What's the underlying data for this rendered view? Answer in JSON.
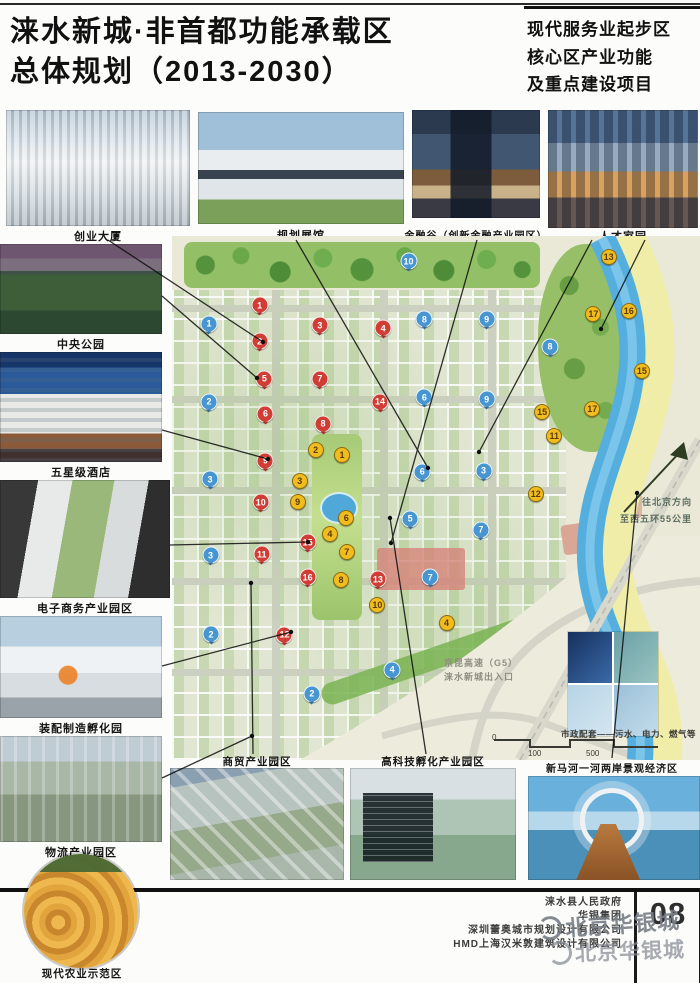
{
  "header": {
    "title_line1": "涞水新城·非首都功能承载区",
    "title_line2": "总体规划（2013-2030）",
    "subtitle_line1": "现代服务业起步区",
    "subtitle_line2": "核心区产业功能",
    "subtitle_line3": "及重点建设项目"
  },
  "top_photos": [
    "创业大厦",
    "规划展馆",
    "金融谷（创新金融产业园区）",
    "人才家园"
  ],
  "left_photos": [
    "中央公园",
    "五星级酒店",
    "电子商务产业园区",
    "装配制造孵化园",
    "物流产业园区",
    "现代农业示范区"
  ],
  "bottom_photos": [
    "商贸产业园区",
    "高科技孵化产业园区",
    "新马河一河两岸景观经济区"
  ],
  "map": {
    "annotations": {
      "direction": "往北京方向",
      "distance": "至西五环55公里",
      "expressway": "京昆高速（G5）",
      "exit": "涞水新城出入口",
      "municipal": "市政配套——污水、电力、燃气等"
    },
    "scale": [
      "0",
      "100",
      "500"
    ],
    "markers": {
      "red": [
        [
          "1",
          16.6,
          13.2
        ],
        [
          "2",
          16.6,
          20.1
        ],
        [
          "3",
          28,
          17
        ],
        [
          "4",
          40,
          17.6
        ],
        [
          "5",
          17.5,
          27.2
        ],
        [
          "6",
          17.7,
          33.9
        ],
        [
          "7",
          28,
          27.2
        ],
        [
          "8",
          28.6,
          35.8
        ],
        [
          "9",
          17.7,
          42.9
        ],
        [
          "10",
          16.8,
          50.8
        ],
        [
          "11",
          17,
          60.7
        ],
        [
          "12",
          21.3,
          76.1
        ],
        [
          "13",
          39,
          65.5
        ],
        [
          "14",
          39.4,
          31.6
        ],
        [
          "15",
          25.7,
          58.4
        ],
        [
          "16",
          25.7,
          65.1
        ]
      ],
      "blue": [
        [
          "1",
          7,
          16.7
        ],
        [
          "2",
          7,
          31.6
        ],
        [
          "3",
          7.2,
          46.4
        ],
        [
          "3",
          7.3,
          60.9
        ],
        [
          "2",
          7.4,
          76
        ],
        [
          "10",
          44.8,
          4.8
        ],
        [
          "8",
          47.8,
          15.9
        ],
        [
          "9",
          59.6,
          15.9
        ],
        [
          "6",
          47.8,
          30.8
        ],
        [
          "9",
          59.6,
          31.2
        ],
        [
          "6",
          47.4,
          45
        ],
        [
          "3",
          59,
          44.8
        ],
        [
          "5",
          45.1,
          54
        ],
        [
          "7",
          58.5,
          56.1
        ],
        [
          "7",
          48.9,
          65.1
        ],
        [
          "8",
          71.6,
          21.1
        ],
        [
          "4",
          41.7,
          82.8
        ],
        [
          "2",
          26.5,
          87.4
        ]
      ],
      "yellow": [
        [
          "2",
          27.2,
          40.8
        ],
        [
          "1",
          32.2,
          41.8
        ],
        [
          "3",
          24.2,
          46.7
        ],
        [
          "9",
          23.8,
          50.8
        ],
        [
          "6",
          33,
          53.8
        ],
        [
          "4",
          29.9,
          56.9
        ],
        [
          "7",
          33.1,
          60.3
        ],
        [
          "8",
          32,
          65.7
        ],
        [
          "10",
          38.9,
          70.5
        ],
        [
          "4",
          52,
          73.8
        ],
        [
          "13",
          82.7,
          4
        ],
        [
          "17",
          79.8,
          14.8
        ],
        [
          "16",
          86.5,
          14.4
        ],
        [
          "15",
          89,
          25.7
        ],
        [
          "15",
          70.1,
          33.5
        ],
        [
          "17",
          79.6,
          33.1
        ],
        [
          "11",
          72.4,
          38.1
        ],
        [
          "12",
          68.9,
          49.2
        ]
      ]
    }
  },
  "footer": {
    "credit1": "涞水县人民政府",
    "credit2": "华银集团",
    "credit3": "深圳蕾奥城市规划设计有限公司",
    "credit4": "HMD上海汉米敦建筑设计有限公司",
    "page_number": "08",
    "watermark": "北京华银城"
  },
  "colors": {
    "marker_red": "#cf3d34",
    "marker_blue": "#4796d2",
    "marker_yellow": "#f0bc1e",
    "river": "#54aede",
    "park_green": "#93c066"
  }
}
